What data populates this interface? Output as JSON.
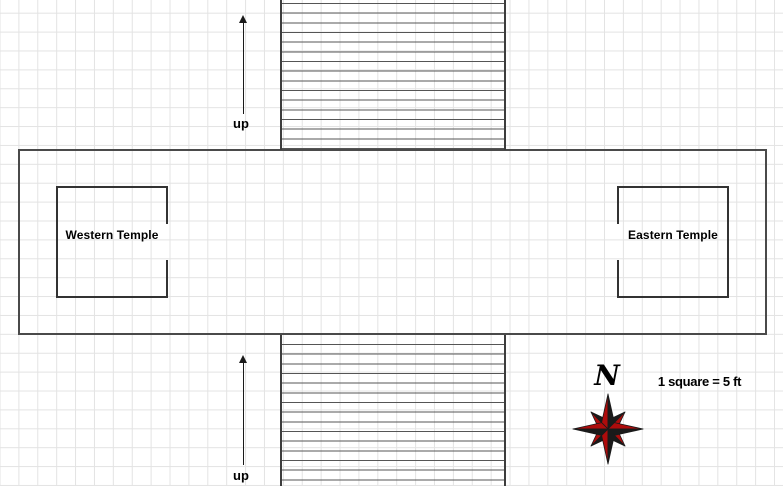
{
  "map": {
    "title_hint": "temple hall floor plan",
    "scale_note": "1 square = 5 ft",
    "compass_label": "N",
    "rooms": [
      {
        "name": "Western Temple"
      },
      {
        "name": "Eastern Temple"
      }
    ],
    "stairs": [
      {
        "id": "north-stairs",
        "direction_label": "up"
      },
      {
        "id": "south-stairs",
        "direction_label": "up"
      }
    ],
    "colors": {
      "grid_line": "#e3e3e3",
      "hall_wall": "#4a4a4a",
      "room_wall": "#333333",
      "stair_wall": "#3d3d3d",
      "stair_tread": "#555555",
      "arrow": "#1a1a1a",
      "text": "#000000",
      "compass_red": "#ae0c0c",
      "compass_black": "#1a1a1a"
    }
  }
}
